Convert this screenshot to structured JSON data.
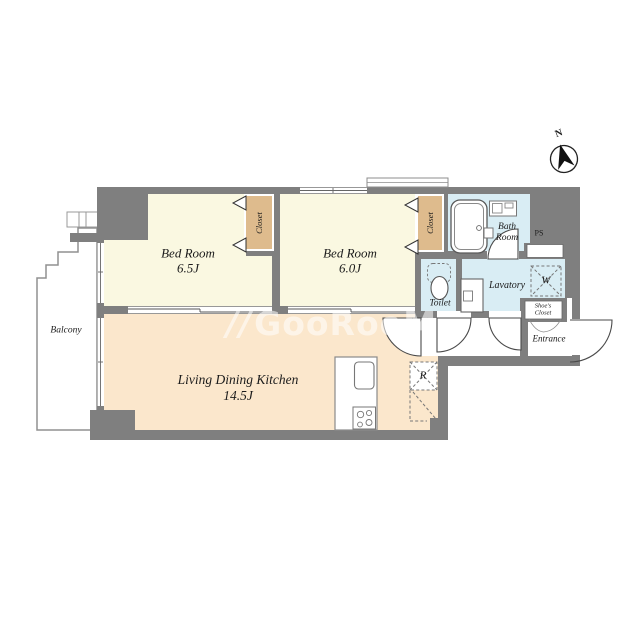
{
  "compass": {
    "label": "N"
  },
  "watermark": {
    "prefix": "//",
    "text": "GooRooM"
  },
  "rooms": {
    "bedroom1": {
      "name": "Bed Room",
      "size": "6.5J"
    },
    "bedroom2": {
      "name": "Bed Room",
      "size": "6.0J"
    },
    "ldk": {
      "name": "Living Dining Kitchen",
      "size": "14.5J"
    },
    "balcony": {
      "name": "Balcony"
    },
    "bathroom": {
      "line1": "Bath",
      "line2": "Room"
    },
    "toilet": {
      "name": "Toilet"
    },
    "lavatory": {
      "name": "Lavatory"
    },
    "entrance": {
      "name": "Entrance"
    },
    "shoes_closet": {
      "line1": "Shoe's",
      "line2": "Closet"
    },
    "closet_bedroom1": {
      "name": "Closet"
    },
    "closet_bedroom2": {
      "name": "Closet"
    },
    "pipe_space": {
      "name": "PS"
    },
    "washing_machine": {
      "label": "W"
    },
    "refrigerator": {
      "label": "R"
    }
  },
  "colors": {
    "wall": "#7f7f7f",
    "bedroom_floor": "#faf8e1",
    "ldk_floor": "#fbe7cc",
    "wet_area_floor": "#d9edf4",
    "closet_fill": "#debb8d",
    "balcony": "#ffffff",
    "watermark": "rgba(255,255,255,0.55)"
  }
}
